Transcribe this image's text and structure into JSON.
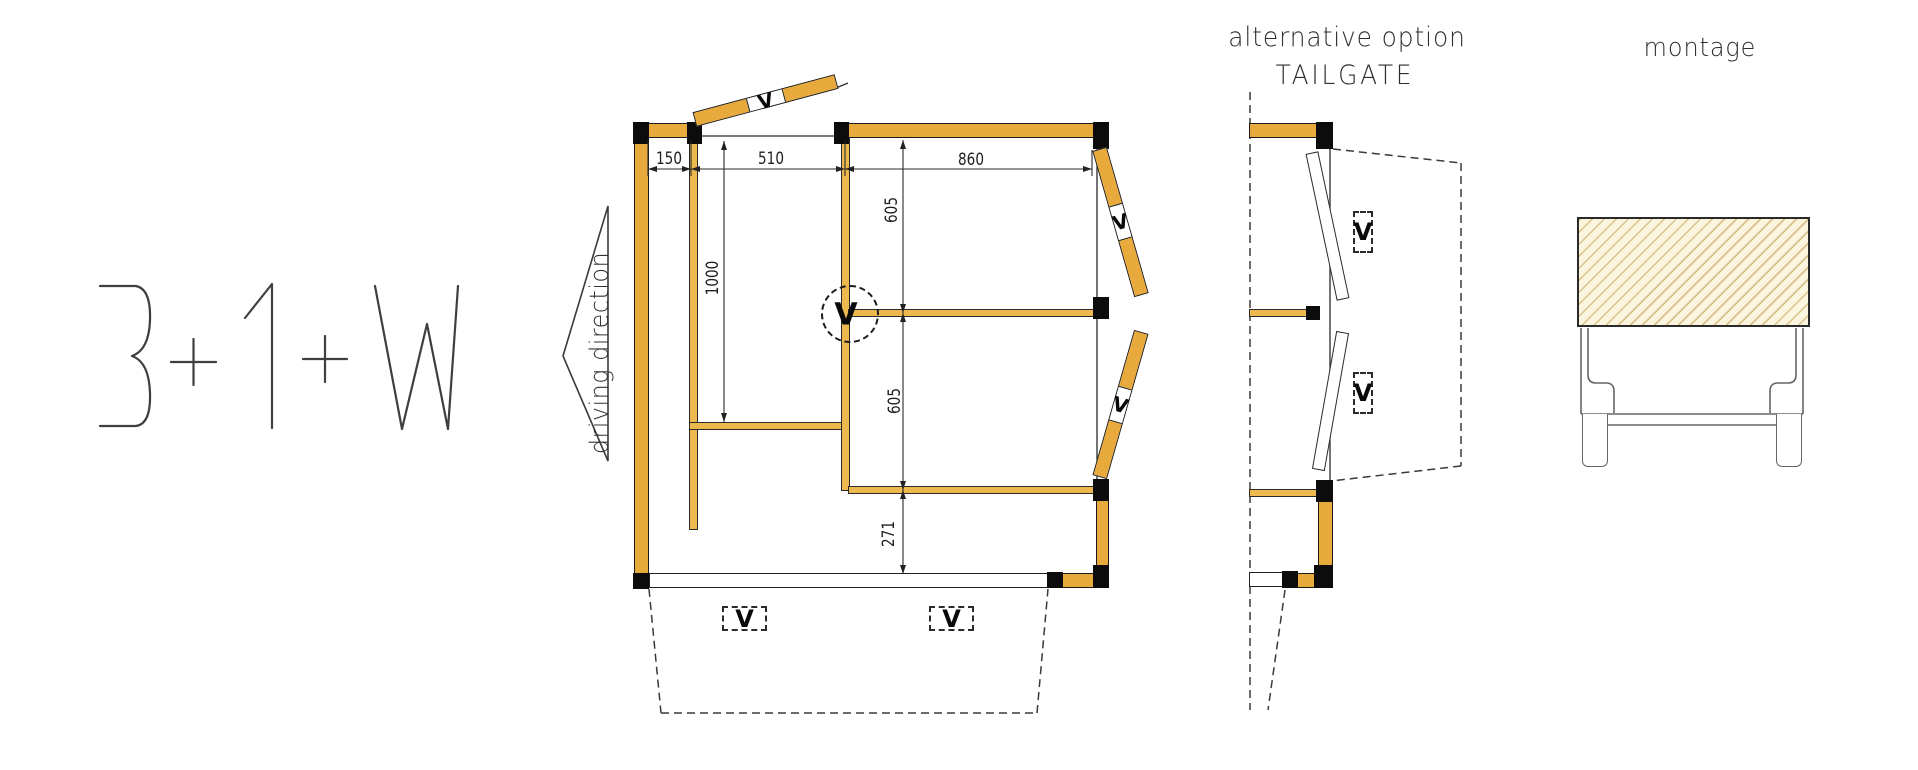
{
  "labels": {
    "config": "3+1+W",
    "driving_direction": "driving direction",
    "alt_option": "alternative option",
    "tailgate": "TAILGATE",
    "montage": "montage",
    "v_mark": "V"
  },
  "dims": {
    "top": [
      "150",
      "510",
      "860"
    ],
    "depth": "1000",
    "right": [
      "605",
      "605",
      "271"
    ]
  },
  "colors": {
    "wood": "#E8AA3D",
    "wood_light": "#EDB94F",
    "hatch_fill": "#FBF4DE",
    "hatch_line": "#D9C38B"
  }
}
